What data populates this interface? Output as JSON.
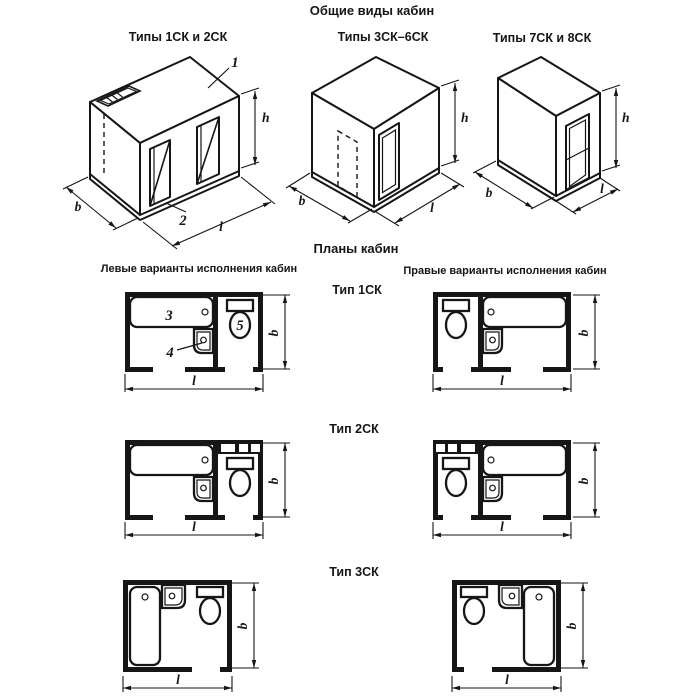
{
  "headings": {
    "general_views": "Общие виды кабин",
    "plans": "Планы кабин",
    "left_variants": "Левые варианты исполнения кабин",
    "right_variants": "Правые варианты исполнения кабин"
  },
  "views": {
    "view1": {
      "title": "Типы 1СК и 2СК"
    },
    "view2": {
      "title": "Типы 3СК–6СК"
    },
    "view3": {
      "title": "Типы 7СК и 8СК"
    }
  },
  "plan_types": {
    "type1": "Тип 1СК",
    "type2": "Тип 2СК",
    "type3": "Тип 3СК"
  },
  "dim_labels": {
    "b": "b",
    "l": "l",
    "h": "h"
  },
  "part_labels": {
    "roof": "1",
    "base": "2",
    "bath": "3",
    "washbasin": "4",
    "toilet": "5"
  },
  "colors": {
    "ink": "#161616",
    "paper": "#ffffff"
  }
}
